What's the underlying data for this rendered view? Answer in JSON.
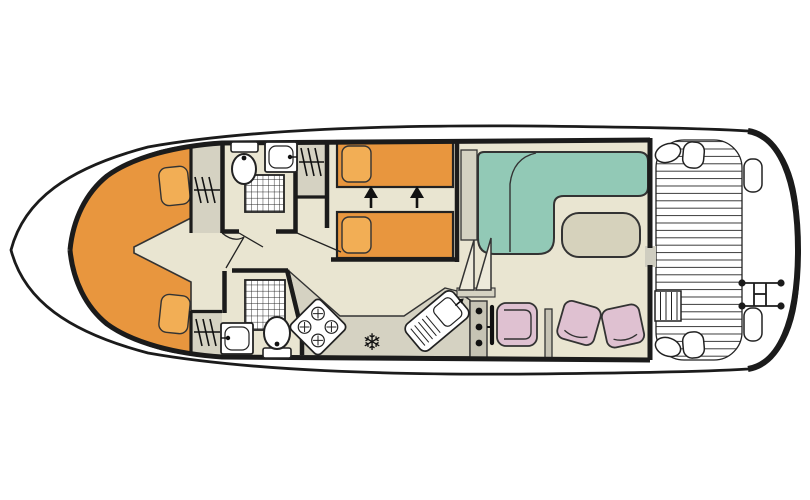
{
  "meta": {
    "diagram_type": "houseboat-deck-plan",
    "orientation": "bow-left-stern-right"
  },
  "colors": {
    "hull_white": "#ffffff",
    "outline_black": "#1b1b1b",
    "floor_cream": "#e9e5d1",
    "counter_gray": "#d5d2c2",
    "console_gray": "#c6c3b4",
    "bed_orange": "#e8963e",
    "pillow_orange": "#f2ae55",
    "sofa_teal": "#92c9b6",
    "table_beige": "#d6d2bc",
    "chair_pink": "#dfc1d1",
    "door_gray": "#cfcdc0",
    "step_light": "#edeadb",
    "line_dark": "#333333"
  },
  "rooms": [
    {
      "id": "bow-cabin",
      "icon": "v-berth-double-bed"
    },
    {
      "id": "shower-room-top",
      "icon": "shower-wc-washbasin"
    },
    {
      "id": "shower-room-bottom",
      "icon": "shower-wc-washbasin"
    },
    {
      "id": "twin-cabin",
      "icon": "two-sliding-single-beds"
    },
    {
      "id": "galley",
      "icon": "hob-fridge-sink"
    },
    {
      "id": "saloon",
      "icon": "sofa-table-helm"
    },
    {
      "id": "aft-deck",
      "icon": "planked-deck-steps-ladder"
    }
  ],
  "furniture_inventory": {
    "double_berth": 1,
    "single_beds": 2,
    "pillows": 4,
    "wardrobes": 3,
    "showers": 2,
    "toilets": 2,
    "washbasins": 2,
    "hob_burners": 4,
    "fridge_freezer": 1,
    "galley_sink_drainer": 1,
    "helm_console": 1,
    "steering_wheel": 1,
    "helm_seat": 1,
    "dining_chairs": 2,
    "l_shaped_sofa": 1,
    "saloon_table": 1,
    "companionway_steps": 2,
    "deck_steps": 1,
    "swim_ladder": 1
  }
}
